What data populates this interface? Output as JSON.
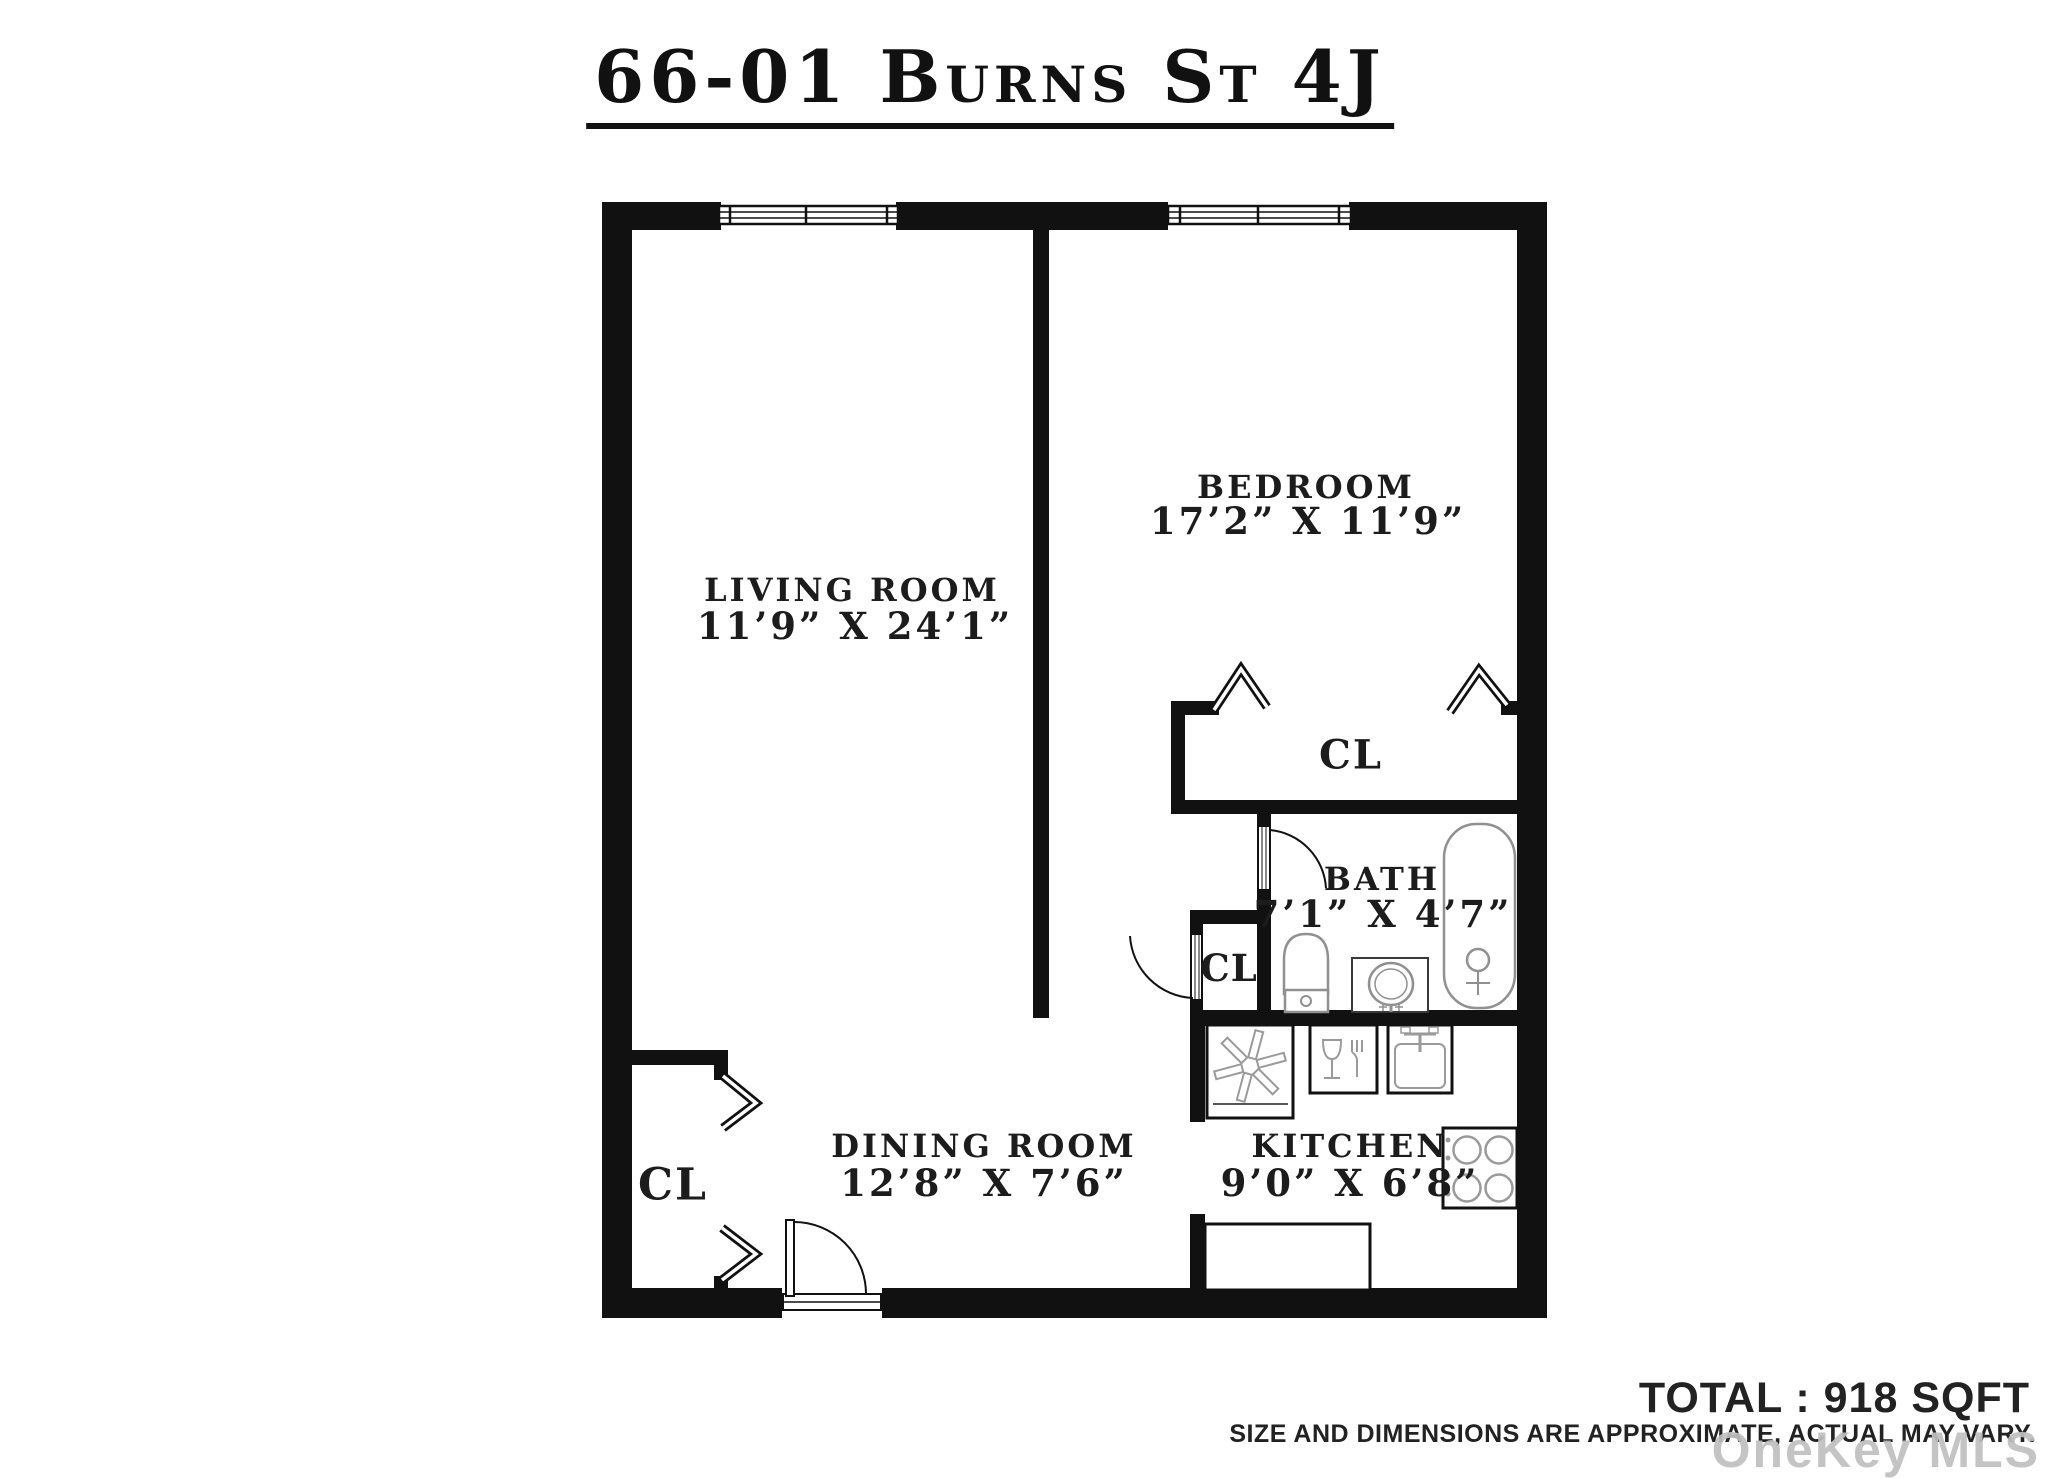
{
  "title": "66-01 Burns St 4J",
  "rooms": {
    "living": {
      "name": "LIVING ROOM",
      "dims": "11’9” X 24’1”"
    },
    "bedroom": {
      "name": "BEDROOM",
      "dims": "17’2” X 11’9”"
    },
    "dining": {
      "name": "DINING ROOM",
      "dims": "12’8” X 7’6”"
    },
    "kitchen": {
      "name": "KITCHEN",
      "dims": "9’0” X 6’8”"
    },
    "bath": {
      "name": "BATH",
      "dims": "7’1” X 4’7”"
    }
  },
  "closets": {
    "bedroom_closet": "CL",
    "hall_closet": "CL",
    "entry_closet": "CL"
  },
  "footer": {
    "total": "TOTAL : 918 SQFT",
    "disclaimer": "SIZE AND DIMENSIONS ARE APPROXIMATE, ACTUAL MAY VARY.",
    "watermark": "OneKey MLS"
  },
  "icons": [
    "window",
    "door-swing",
    "closet-chevron",
    "bathtub",
    "toilet",
    "bath-sink",
    "kitchen-sink",
    "stove",
    "refrigerator-fan",
    "dishwasher",
    "counter"
  ],
  "colors": {
    "wall": "#111111",
    "fixture": "#909090",
    "box_outline": "#111111",
    "watermark": "#c0c0c0"
  }
}
